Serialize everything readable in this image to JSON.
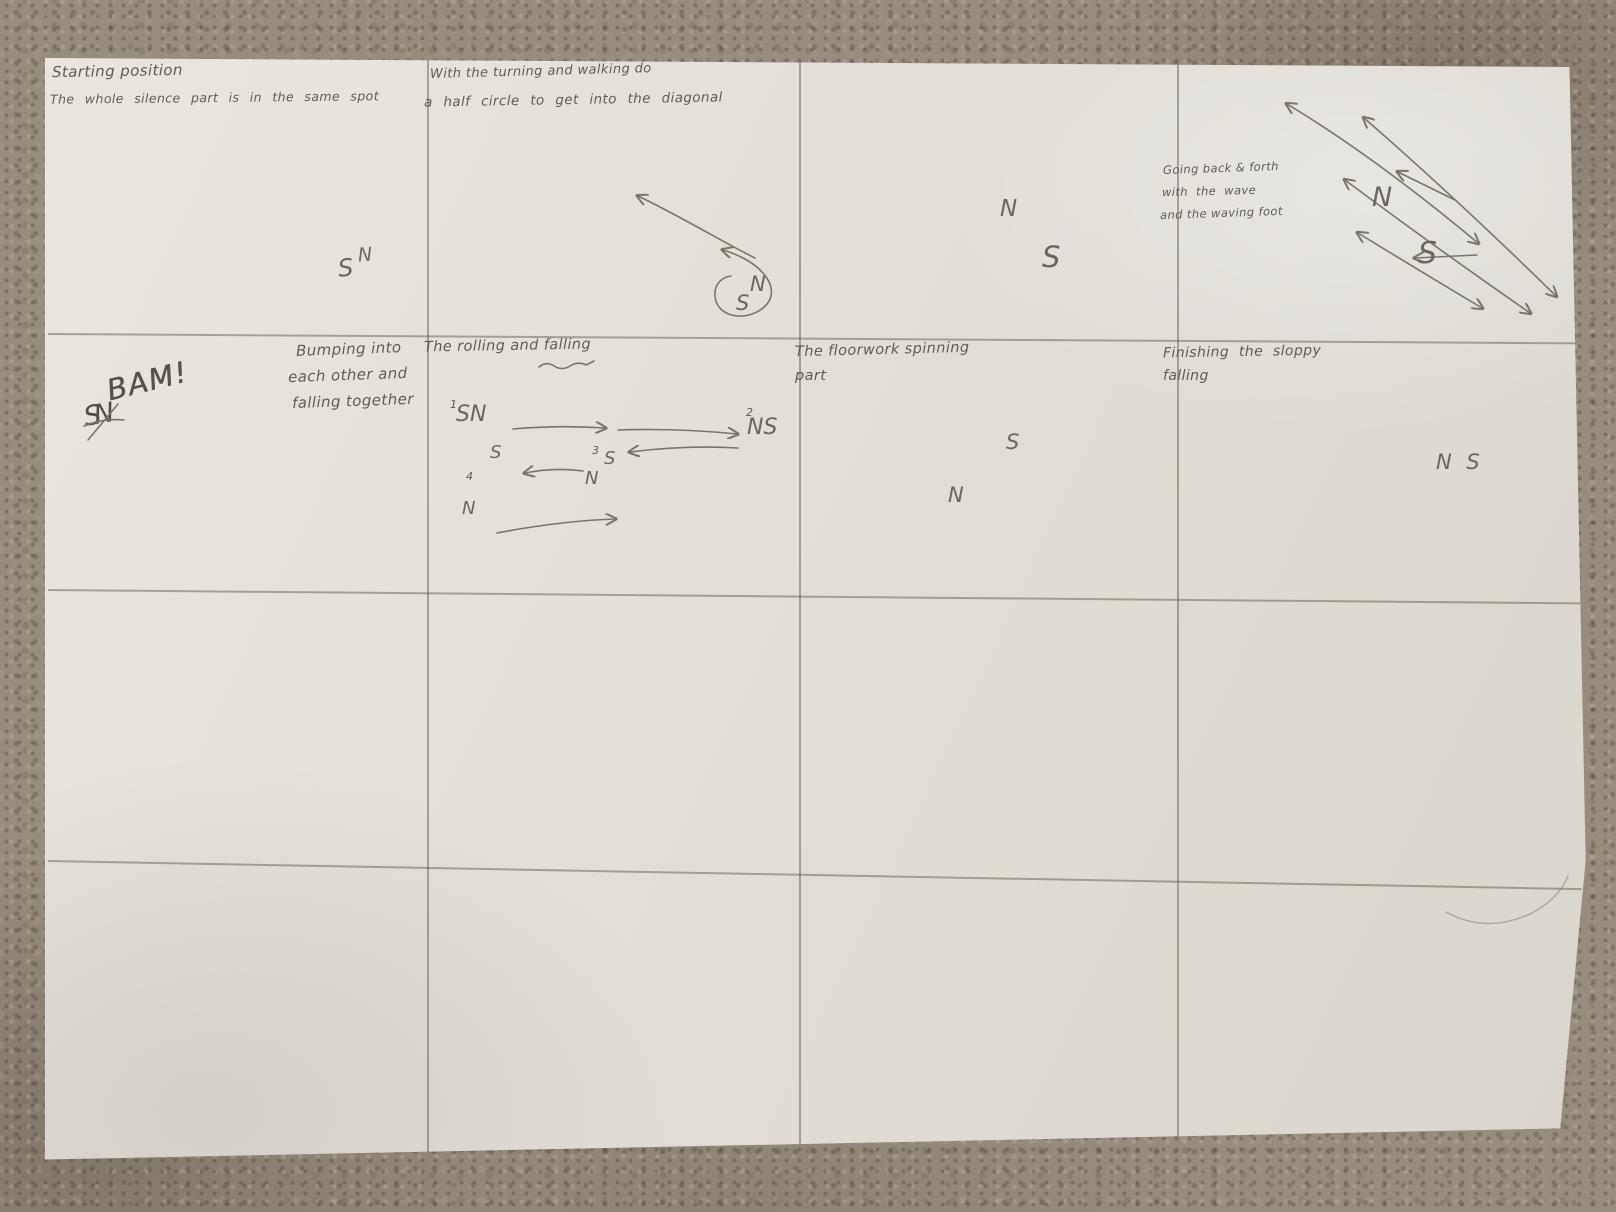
{
  "colors": {
    "paper": "#e2dfd8",
    "carpet": "#978d7d",
    "pencil": "#7a7568",
    "handwriting": "#5f5c55"
  },
  "cells": {
    "r1c1": {
      "line1": "Starting position",
      "line2": "The whole silence part is in the same spot",
      "s": "S",
      "n": "N"
    },
    "r1c2": {
      "line1": "With the turning and walking do",
      "line2": "a half circle to get into the diagonal",
      "n": "N",
      "s": "S"
    },
    "r1c3": {
      "n": "N",
      "s": "S"
    },
    "r1c4": {
      "line1": "Going back & forth",
      "line2": "with the wave",
      "line3": "and the waving foot",
      "n": "N",
      "s": "S"
    },
    "r2c1": {
      "sn": "SN",
      "bam": "BAM!",
      "line1": "Bumping into",
      "line2": "each other and",
      "line3": "falling together"
    },
    "r2c2": {
      "title": "The rolling and falling",
      "num1": "1",
      "sn": "SN",
      "num2": "2",
      "ns": "NS",
      "s_left": "S",
      "num3": "3",
      "s_mid": "S",
      "n_mid": "N",
      "num4": "4",
      "n_bottom": "N"
    },
    "r2c3": {
      "line1": "The floorwork spinning",
      "line2": "part",
      "s": "S",
      "n": "N"
    },
    "r2c4": {
      "line1": "Finishing the sloppy",
      "line2": "falling",
      "ns": "N S"
    }
  }
}
